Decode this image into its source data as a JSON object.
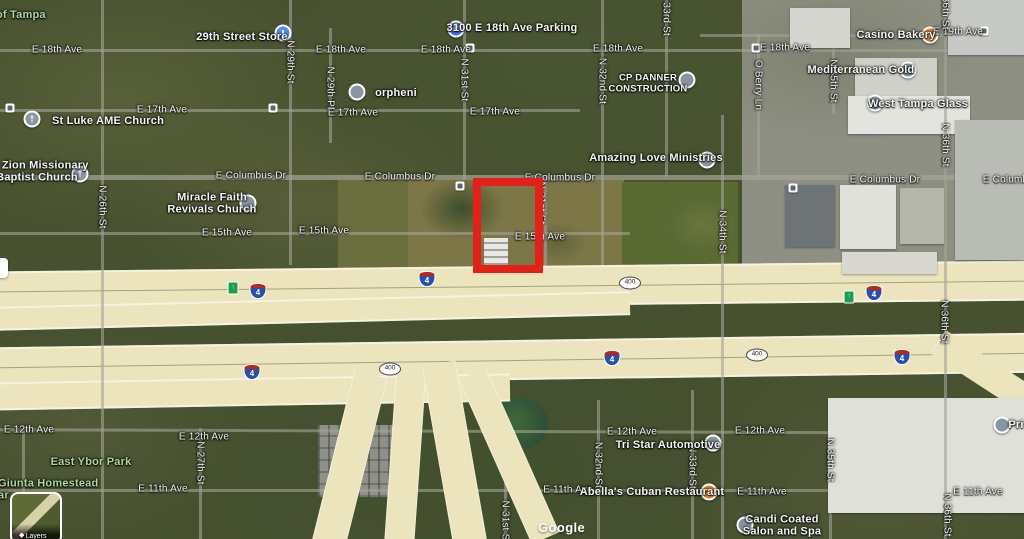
{
  "attribution": "Google",
  "layers_control": {
    "label": "Layers"
  },
  "highlight": {
    "x": 473,
    "y": 178,
    "w": 70,
    "h": 95,
    "color": "#e32119"
  },
  "colors": {
    "interstate_blue": "#2850a7",
    "interstate_red": "#b5281f",
    "exit_green": "#1d9e50",
    "poi_orange": "#ef8b2d",
    "poi_blue": "#4e8df6",
    "park_green_text": "#aed8a0",
    "highway_pavement": "#ece4bd"
  },
  "street_labels": [
    {
      "t": "E 18th Ave",
      "x": 57,
      "y": 50
    },
    {
      "t": "E 18th Ave",
      "x": 341,
      "y": 50
    },
    {
      "t": "E 18th Ave",
      "x": 446,
      "y": 50
    },
    {
      "t": "E 18th Ave",
      "x": 618,
      "y": 49
    },
    {
      "t": "E 18th Ave",
      "x": 785,
      "y": 48
    },
    {
      "t": "E 19th Ave",
      "x": 958,
      "y": 32
    },
    {
      "t": "E 17th Ave",
      "x": 162,
      "y": 110
    },
    {
      "t": "E 17th Ave",
      "x": 353,
      "y": 113
    },
    {
      "t": "E 17th Ave",
      "x": 495,
      "y": 112
    },
    {
      "t": "E Columbus Dr",
      "x": 251,
      "y": 176
    },
    {
      "t": "E Columbus Dr",
      "x": 400,
      "y": 177
    },
    {
      "t": "E Columbus Dr",
      "x": 560,
      "y": 178
    },
    {
      "t": "E Columbus Dr",
      "x": 885,
      "y": 180
    },
    {
      "t": "E Columbus Dr",
      "x": 1018,
      "y": 180
    },
    {
      "t": "E 15th Ave",
      "x": 227,
      "y": 233
    },
    {
      "t": "E 15th Ave",
      "x": 324,
      "y": 231
    },
    {
      "t": "E 15th Ave",
      "x": 540,
      "y": 237
    },
    {
      "t": "E 12th Ave",
      "x": 29,
      "y": 430
    },
    {
      "t": "E 12th Ave",
      "x": 204,
      "y": 437
    },
    {
      "t": "E 12th Ave",
      "x": 632,
      "y": 432
    },
    {
      "t": "E 12th Ave",
      "x": 760,
      "y": 431
    },
    {
      "t": "E 11th Ave",
      "x": 163,
      "y": 489
    },
    {
      "t": "E 11th Ave",
      "x": 568,
      "y": 490
    },
    {
      "t": "E 11th Ave",
      "x": 762,
      "y": 492
    },
    {
      "t": "E 11th Ave",
      "x": 978,
      "y": 492
    },
    {
      "t": "N 29th St",
      "x": 290,
      "y": 62,
      "v": true
    },
    {
      "t": "N 29th Pl",
      "x": 330,
      "y": 88,
      "v": true
    },
    {
      "t": "N 26th St",
      "x": 102,
      "y": 207,
      "v": true
    },
    {
      "t": "N 31st St",
      "x": 464,
      "y": 80,
      "v": true
    },
    {
      "t": "N 31st St",
      "x": 541,
      "y": 203,
      "v": true
    },
    {
      "t": "N 31st St",
      "x": 505,
      "y": 522,
      "v": true
    },
    {
      "t": "N 32nd St",
      "x": 602,
      "y": 81,
      "v": true
    },
    {
      "t": "N 32nd St",
      "x": 598,
      "y": 465,
      "v": true
    },
    {
      "t": "N 33rd St",
      "x": 666,
      "y": 14,
      "v": true
    },
    {
      "t": "N 33rd St",
      "x": 692,
      "y": 467,
      "v": true
    },
    {
      "t": "N 34th St",
      "x": 722,
      "y": 232,
      "v": true
    },
    {
      "t": "N 35th St",
      "x": 833,
      "y": 81,
      "v": true
    },
    {
      "t": "N 35th St",
      "x": 830,
      "y": 460,
      "v": true
    },
    {
      "t": "O Berry Ln",
      "x": 758,
      "y": 85,
      "v": true
    },
    {
      "t": "N 36th St",
      "x": 945,
      "y": 8,
      "v": true
    },
    {
      "t": "N 36th St",
      "x": 945,
      "y": 145,
      "v": true
    },
    {
      "t": "N 36th St",
      "x": 944,
      "y": 322,
      "v": true
    },
    {
      "t": "N 36th St",
      "x": 947,
      "y": 515,
      "v": true
    },
    {
      "t": "N 27th St",
      "x": 200,
      "y": 463,
      "v": true
    }
  ],
  "poi_labels": [
    {
      "lines": [
        "of Tampa"
      ],
      "x": -4,
      "y": 15,
      "cls": "green left"
    },
    {
      "lines": [
        "29th Street Store"
      ],
      "x": 242,
      "y": 37
    },
    {
      "lines": [
        "3100 E 18th Ave Parking"
      ],
      "x": 512,
      "y": 28
    },
    {
      "lines": [
        "Casino Bakery"
      ],
      "x": 896,
      "y": 35
    },
    {
      "lines": [
        "St Luke AME Church"
      ],
      "x": 108,
      "y": 121
    },
    {
      "lines": [
        "Mt Zion Missionary",
        "Baptist Church"
      ],
      "x": 37,
      "y": 172
    },
    {
      "lines": [
        "orpheni"
      ],
      "x": 396,
      "y": 93
    },
    {
      "lines": [
        "CP DANNER",
        "CONSTRUCTION"
      ],
      "x": 648,
      "y": 84,
      "cls": "caps"
    },
    {
      "lines": [
        "Mediterranean Gold"
      ],
      "x": 861,
      "y": 70
    },
    {
      "lines": [
        "West Tampa Glass"
      ],
      "x": 918,
      "y": 104
    },
    {
      "lines": [
        "Amazing Love Ministries"
      ],
      "x": 656,
      "y": 158
    },
    {
      "lines": [
        "Miracle Faith",
        "Revivals Church"
      ],
      "x": 212,
      "y": 204
    },
    {
      "lines": [
        "East Ybor Park"
      ],
      "x": 91,
      "y": 462,
      "cls": "green"
    },
    {
      "lines": [
        "Giunta Homestead",
        "ar"
      ],
      "x": -2,
      "y": 490,
      "cls": "green left"
    },
    {
      "lines": [
        "Tri Star Automotive"
      ],
      "x": 668,
      "y": 445
    },
    {
      "lines": [
        "Abella's Cuban Restaurant"
      ],
      "x": 652,
      "y": 492
    },
    {
      "lines": [
        "Candi Coated",
        "Salon and Spa"
      ],
      "x": 782,
      "y": 526
    },
    {
      "lines": [
        "Pri"
      ],
      "x": 1016,
      "y": 425
    }
  ],
  "pins": [
    {
      "type": "store",
      "x": 283,
      "y": 33
    },
    {
      "type": "parking",
      "x": 456,
      "y": 29
    },
    {
      "type": "restaurant",
      "x": 930,
      "y": 35
    },
    {
      "type": "church",
      "x": 32,
      "y": 119
    },
    {
      "type": "church",
      "x": 80,
      "y": 174
    },
    {
      "type": "generic",
      "x": 357,
      "y": 92
    },
    {
      "type": "generic",
      "x": 687,
      "y": 80
    },
    {
      "type": "generic",
      "x": 908,
      "y": 70
    },
    {
      "type": "generic",
      "x": 875,
      "y": 103
    },
    {
      "type": "generic",
      "x": 707,
      "y": 160
    },
    {
      "type": "generic",
      "x": 248,
      "y": 203
    },
    {
      "type": "generic",
      "x": 713,
      "y": 443
    },
    {
      "type": "restaurant",
      "x": 709,
      "y": 492
    },
    {
      "type": "generic",
      "x": 745,
      "y": 525
    },
    {
      "type": "generic",
      "x": 1002,
      "y": 425
    }
  ],
  "icon_glyphs": {
    "parking": "P",
    "church": "†",
    "restaurant": "▮",
    "store": "▮",
    "generic": ""
  },
  "shields": [
    {
      "type": "i4",
      "t": "4",
      "x": 258,
      "y": 291
    },
    {
      "type": "i4",
      "t": "4",
      "x": 427,
      "y": 279
    },
    {
      "type": "i4",
      "t": "4",
      "x": 874,
      "y": 293
    },
    {
      "type": "i4",
      "t": "4",
      "x": 252,
      "y": 372
    },
    {
      "type": "i4",
      "t": "4",
      "x": 612,
      "y": 358
    },
    {
      "type": "i4",
      "t": "4",
      "x": 902,
      "y": 357
    },
    {
      "type": "fl400",
      "t": "400",
      "x": 630,
      "y": 283
    },
    {
      "type": "fl400",
      "t": "400",
      "x": 390,
      "y": 369
    },
    {
      "type": "fl400",
      "t": "400",
      "x": 757,
      "y": 355
    },
    {
      "type": "exitshield",
      "t": "↑",
      "x": 233,
      "y": 288
    },
    {
      "type": "exitshield",
      "t": "↑",
      "x": 849,
      "y": 297
    }
  ],
  "transit_icons": [
    {
      "x": 10,
      "y": 108
    },
    {
      "x": 273,
      "y": 108
    },
    {
      "x": 470,
      "y": 48
    },
    {
      "x": 756,
      "y": 48
    },
    {
      "x": 984,
      "y": 31
    },
    {
      "x": 460,
      "y": 186
    },
    {
      "x": 793,
      "y": 188
    }
  ]
}
